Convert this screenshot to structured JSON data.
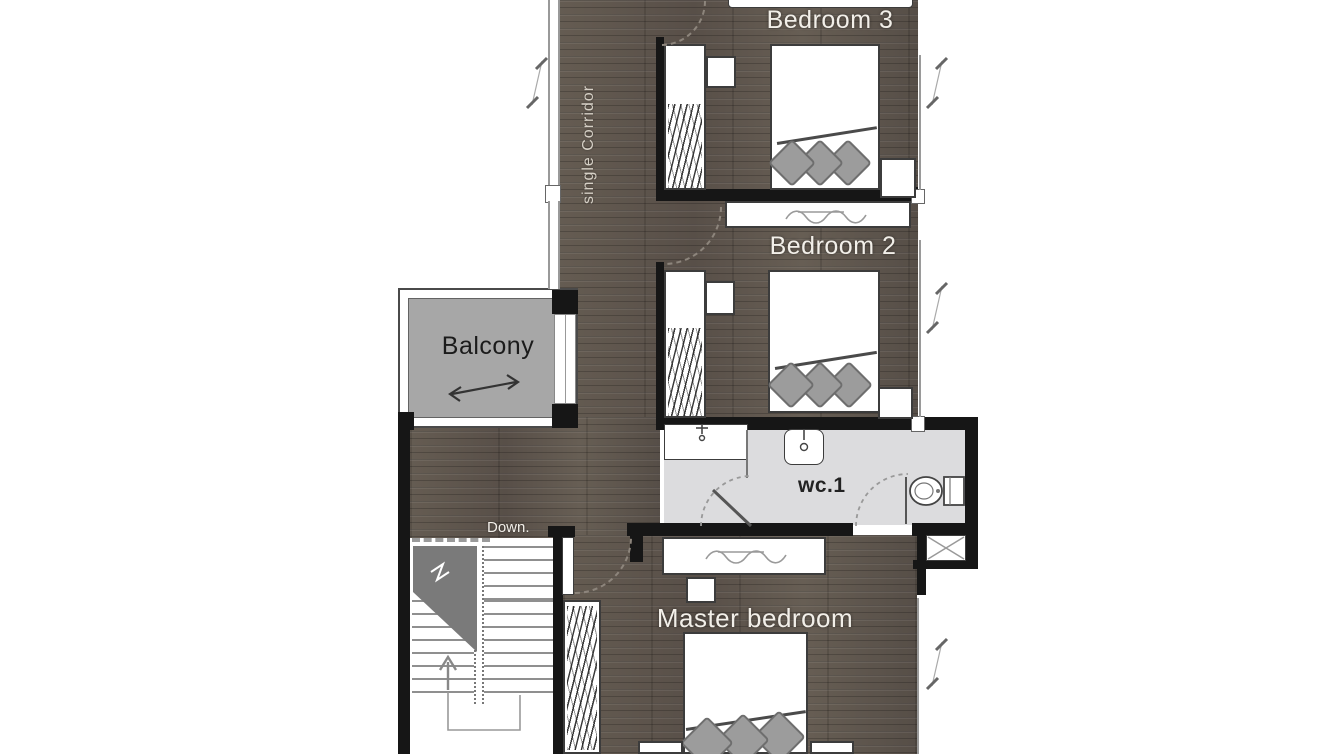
{
  "floor_plan": {
    "labels": {
      "bedroom3": "Bedroom 3",
      "bedroom2": "Bedroom 2",
      "master_bedroom": "Master bedroom",
      "balcony": "Balcony",
      "wc": "wc.1",
      "corridor": "single Corridor",
      "stairs": "Down."
    },
    "colors": {
      "wood_floor": "#5d554c",
      "balcony_floor": "#a7a7a7",
      "wc_floor": "#dcdcde",
      "wall": "#161616",
      "furniture_fill": "#ffffff",
      "furniture_outline": "#3c3c3c",
      "pillow": "#9c9c9c",
      "label_text": "#f2efe9"
    }
  }
}
